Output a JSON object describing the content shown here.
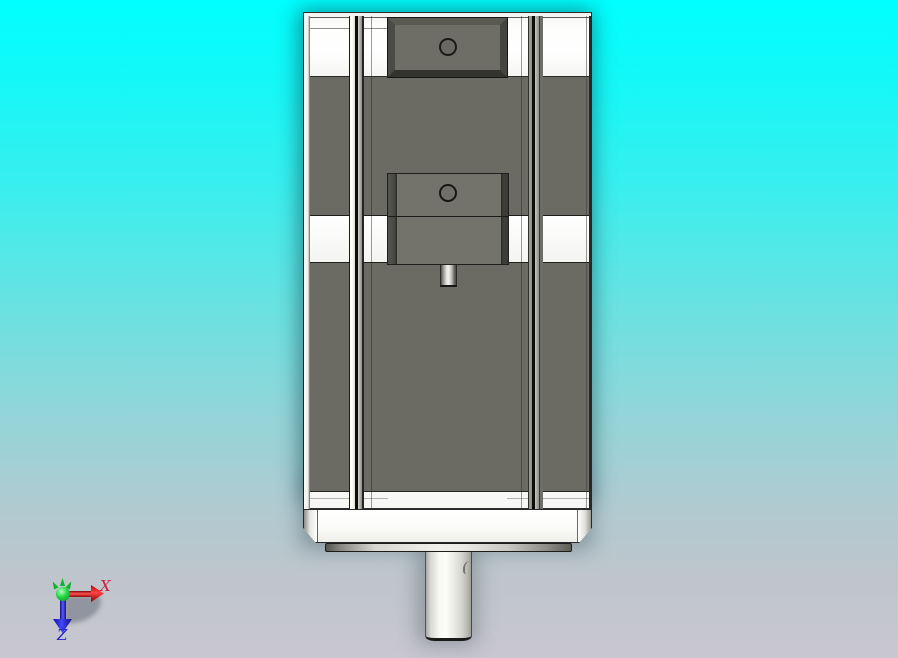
{
  "viewport": {
    "type": "3d-cad-viewport",
    "background_top_color": "#00ffff",
    "background_bottom_color": "#c9c7d0"
  },
  "model": {
    "description": "stepper-motor-with-gearbox-front-view",
    "body_color": "#6b6b64",
    "metal_face_color": "#fafaf8",
    "outline_color": "#1e1e1c"
  },
  "triad": {
    "x_axis": {
      "label": "X",
      "color": "#cb1f3c"
    },
    "y_axis": {
      "color": "#12c02a"
    },
    "z_axis": {
      "label": "Z",
      "color": "#2020ce"
    }
  }
}
